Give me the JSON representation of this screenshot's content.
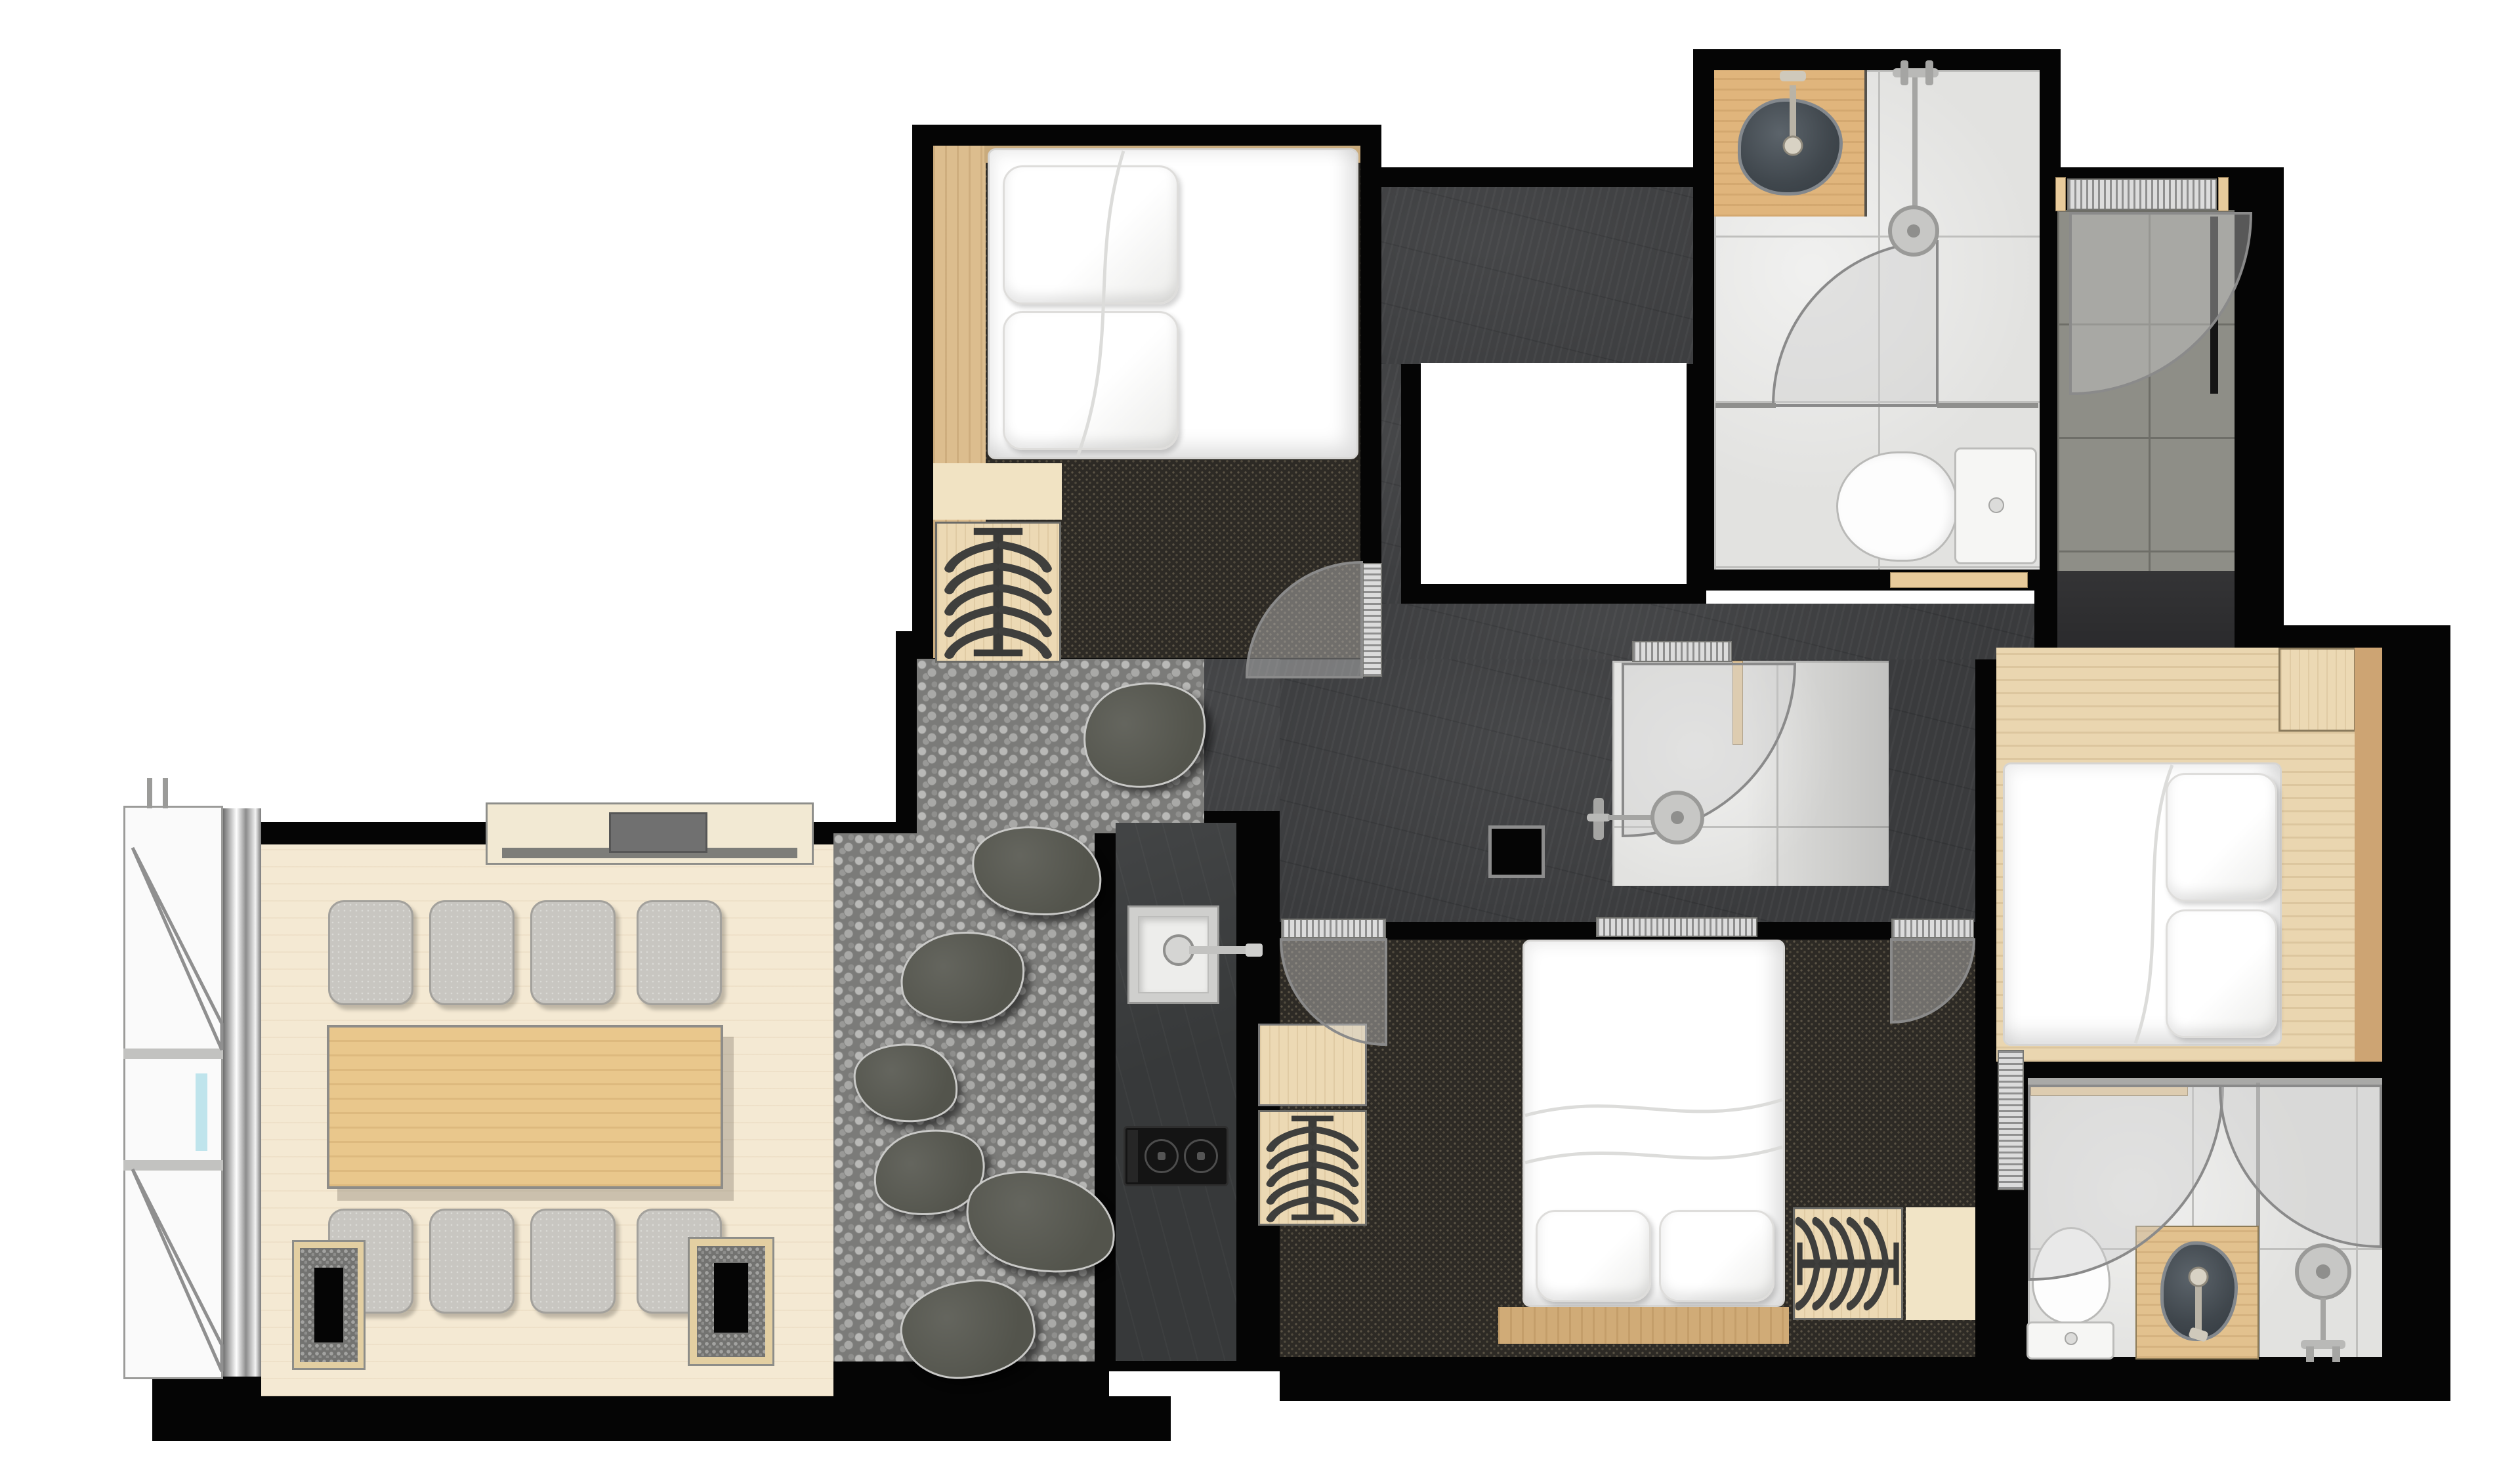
{
  "document": {
    "type": "apartment-floor-plan",
    "style": "top-down rendered plan, no text labels",
    "background_color": "#ffffff"
  },
  "palette": {
    "wall": "#050505",
    "slate_corridor_floor": "#3a3b3d",
    "entry_dark_floor": "#29292b",
    "bedroom_carpet": "#2d2a25",
    "pebble_garden": "#7b7b79",
    "bathroom_tile_light": "#e2e2e0",
    "entry_tile_gray": "#8e8e87",
    "dining_wood_floor": "#f4e9d3",
    "plank_wood": "#dcbd8e",
    "table_wood": "#e9c78c",
    "chair_gray": "#c8c6c1",
    "bedding": "#ffffff",
    "stone_sink": "#474d52",
    "kitchen_counter": "#37393a",
    "door_swing_arc": "#8a8a8a",
    "curtain_silver": "#c7c7c5",
    "glass_blue": "#bfe4ec"
  },
  "rooms": [
    {
      "id": "bedroom-1",
      "position": "top-left",
      "floor": "dark carpet + wood strip",
      "contents": [
        "double bed with 2 pillows",
        "wardrobe with hangers",
        "swing door",
        "sliding leaf"
      ]
    },
    {
      "id": "bathroom-1",
      "position": "top-right",
      "floor": "light stone tile",
      "contents": [
        "wood vanity with stone vessel sink and faucet",
        "walk-in shower with fixture",
        "toilet with tank",
        "door swing"
      ]
    },
    {
      "id": "entry",
      "position": "far top-right",
      "floor": "gray stone tile + dark lower landing",
      "contents": [
        "entrance door with swing arc"
      ]
    },
    {
      "id": "corridor",
      "position": "center",
      "floor": "dark slate",
      "contents": [
        "void cutout (white)"
      ]
    },
    {
      "id": "zen-garden",
      "position": "center-left",
      "floor": "pebbles",
      "contents": [
        "7 stepping stones"
      ]
    },
    {
      "id": "kitchen",
      "position": "center",
      "floor": "slate island",
      "contents": [
        "undermount sink with lever faucet",
        "two-burner cooktop"
      ]
    },
    {
      "id": "shower-room",
      "position": "center",
      "floor": "light tile",
      "contents": [
        "shower fixture",
        "swing door",
        "glazed hatch"
      ]
    },
    {
      "id": "dining-room",
      "position": "bottom-left",
      "floor": "pale wood",
      "contents": [
        "dining table",
        "8 cushion chairs",
        "tv console",
        "2 pebble floor lanterns",
        "bay window with casements and curtain"
      ]
    },
    {
      "id": "bedroom-2",
      "position": "bottom-center",
      "floor": "dark carpet",
      "contents": [
        "double bed, pillows at foot",
        "nightstand",
        "2 wardrobes with hangers",
        "2 swing doors"
      ]
    },
    {
      "id": "bedroom-3",
      "position": "right",
      "floor": "pale wood",
      "contents": [
        "double bed, pillows at right",
        "nightstand",
        "headboard plank"
      ]
    },
    {
      "id": "bathroom-2",
      "position": "bottom-right",
      "floor": "light stone tile",
      "contents": [
        "toilet with tank",
        "wood vanity with stone vessel sink",
        "shower fixture",
        "2 door swings",
        "sliding door"
      ]
    }
  ],
  "counts": {
    "beds": 3,
    "pillows": 6,
    "toilets": 2,
    "vessel_sinks": 2,
    "kitchen_sinks": 1,
    "showers": 3,
    "wardrobe_hanger_icons": 4,
    "dining_chairs": 8,
    "stepping_stones": 7,
    "door_swing_arcs": 8,
    "sliding_hatch_doors": 7,
    "floor_lanterns": 2,
    "window_casements": 2
  },
  "icons": [
    "hanger-rack-icon",
    "shower-head-icon",
    "faucet-icon",
    "cooktop-burner-icon",
    "door-swing-arc",
    "casement-window-swing",
    "toilet-icon",
    "tv-icon"
  ]
}
